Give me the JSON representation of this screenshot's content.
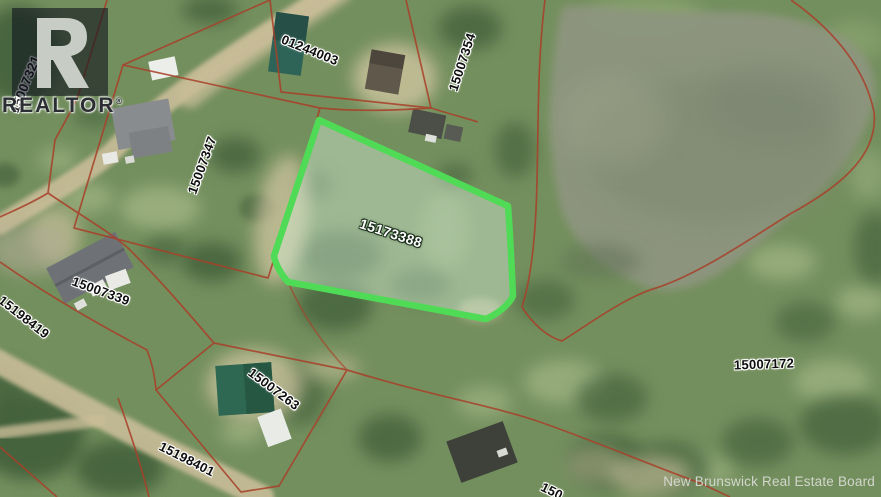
{
  "map": {
    "type": "aerial parcel map",
    "colors": {
      "boundary_red": "#a8402a",
      "highlight_green": "#4fdb55",
      "terrain_green": "#748f5e",
      "water_gray_green": "#8d957e",
      "road_tan": "#c9bd98"
    }
  },
  "highlighted_parcel": {
    "id": "15173388"
  },
  "parcels": [
    {
      "id": "15007321"
    },
    {
      "id": "01244003"
    },
    {
      "id": "15007354"
    },
    {
      "id": "15007347"
    },
    {
      "id": "15007339"
    },
    {
      "id": "15198419"
    },
    {
      "id": "15007263"
    },
    {
      "id": "15198401"
    },
    {
      "id": "15007172"
    }
  ],
  "partial_parcel_label": {
    "visible_text": "150"
  },
  "branding": {
    "realtor_text": "REALTOR",
    "registered_symbol": "®"
  },
  "attribution": {
    "text": "New Brunswick Real Estate Board"
  }
}
